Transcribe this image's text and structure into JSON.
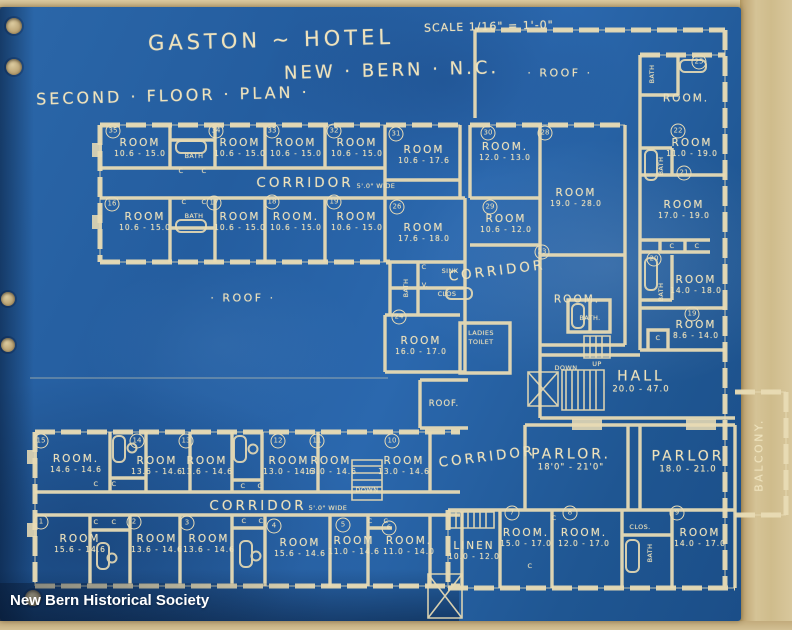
{
  "title": {
    "hotel": "GASTON ~ HOTEL",
    "city": "NEW · BERN · N.C.",
    "plan": "SECOND · FLOOR · PLAN ·",
    "scale": "SCALE 1/16\" = 1'-0\""
  },
  "watermark": "New Bern Historical Society",
  "colors": {
    "blueprint_blue": "#24609f",
    "line_cream": "#e9dcb6",
    "paper_tan": "#cfbb8f"
  },
  "plan": {
    "rooms": [
      {
        "n": "35",
        "t": "ROOM",
        "d": "10.6 - 15.0",
        "x": 140,
        "y": 148,
        "nx": 113,
        "ny": 131
      },
      {
        "n": "34",
        "t": "ROOM",
        "d": "10.6 - 15.0",
        "x": 240,
        "y": 148,
        "nx": 216,
        "ny": 131
      },
      {
        "n": "33",
        "t": "ROOM",
        "d": "10.6 - 15.0",
        "x": 296,
        "y": 148,
        "nx": 272,
        "ny": 131
      },
      {
        "n": "32",
        "t": "ROOM",
        "d": "10.6 - 15.0",
        "x": 357,
        "y": 148,
        "nx": 334,
        "ny": 131
      },
      {
        "n": "31",
        "t": "ROOM",
        "d": "10.6 - 17.6",
        "x": 424,
        "y": 155,
        "nx": 396,
        "ny": 134
      },
      {
        "n": "16",
        "t": "ROOM",
        "d": "10.6 - 15.0",
        "x": 145,
        "y": 222,
        "nx": 112,
        "ny": 204
      },
      {
        "n": "17",
        "t": "ROOM",
        "d": "10.6 - 15.0",
        "x": 240,
        "y": 222,
        "nx": 214,
        "ny": 203
      },
      {
        "n": "18",
        "t": "ROOM.",
        "d": "10.6 - 15.0",
        "x": 296,
        "y": 222,
        "nx": 272,
        "ny": 202
      },
      {
        "n": "19",
        "t": "ROOM",
        "d": "10.6 - 15.0",
        "x": 357,
        "y": 222,
        "nx": 334,
        "ny": 202
      },
      {
        "n": "26",
        "t": "ROOM",
        "d": "17.6 - 18.0",
        "x": 424,
        "y": 233,
        "nx": 397,
        "ny": 207
      },
      {
        "n": "30",
        "t": "ROOM.",
        "d": "12.0 - 13.0",
        "x": 505,
        "y": 152,
        "nx": 488,
        "ny": 133
      },
      {
        "n": "28",
        "t": "ROOM",
        "d": "19.0 - 28.0",
        "x": 576,
        "y": 198,
        "nx": 545,
        "ny": 133
      },
      {
        "n": "29",
        "t": "ROOM",
        "d": "10.6 - 12.0",
        "x": 506,
        "y": 224,
        "nx": 490,
        "ny": 207
      },
      {
        "n": "24",
        "t": "ROOM",
        "d": "16.0 - 17.0",
        "x": 421,
        "y": 346,
        "nx": 399,
        "ny": 317
      },
      {
        "n": "23",
        "t": "ROOM.",
        "d": null,
        "x": 577,
        "y": 300,
        "nx": 542,
        "ny": 252
      },
      {
        "n": "25",
        "t": "ROOM.",
        "d": null,
        "x": 686,
        "y": 99,
        "nx": 699,
        "ny": 62
      },
      {
        "n": "22",
        "t": "ROOM",
        "d": "11.0 - 19.0",
        "x": 692,
        "y": 148,
        "nx": 678,
        "ny": 131
      },
      {
        "n": "21",
        "t": "ROOM",
        "d": "17.0 - 19.0",
        "x": 684,
        "y": 210,
        "nx": 684,
        "ny": 173
      },
      {
        "n": "20",
        "t": "ROOM",
        "d": "14.0 - 18.0",
        "x": 696,
        "y": 285,
        "nx": 654,
        "ny": 259
      },
      {
        "n": "19",
        "t": "ROOM",
        "d": "8.6 - 14.0",
        "x": 696,
        "y": 330,
        "nx": 692,
        "ny": 314
      },
      {
        "n": "15",
        "t": "ROOM.",
        "d": "14.6 - 14.6",
        "x": 76,
        "y": 464,
        "nx": 41,
        "ny": 441
      },
      {
        "n": "14",
        "t": "ROOM",
        "d": "13.6 - 14.6",
        "x": 157,
        "y": 466,
        "nx": 137,
        "ny": 441
      },
      {
        "n": "13",
        "t": "ROOM",
        "d": "13.6 - 14.6",
        "x": 207,
        "y": 466,
        "nx": 186,
        "ny": 441
      },
      {
        "n": "12",
        "t": "ROOM",
        "d": "13.0 - 14.6",
        "x": 289,
        "y": 466,
        "nx": 278,
        "ny": 441
      },
      {
        "n": "11",
        "t": "ROOM",
        "d": "13.0 - 14.6",
        "x": 331,
        "y": 466,
        "nx": 317,
        "ny": 441
      },
      {
        "n": "10",
        "t": "ROOM",
        "d": "13.0 - 14.6",
        "x": 404,
        "y": 466,
        "nx": 392,
        "ny": 441
      },
      {
        "n": "1",
        "t": "ROOM",
        "d": "15.6 - 14.6",
        "x": 80,
        "y": 544,
        "nx": 41,
        "ny": 522
      },
      {
        "n": "2",
        "t": "ROOM",
        "d": "13.6 - 14.6",
        "x": 157,
        "y": 544,
        "nx": 134,
        "ny": 522
      },
      {
        "n": "3",
        "t": "ROOM",
        "d": "13.6 - 14.6",
        "x": 209,
        "y": 544,
        "nx": 187,
        "ny": 523
      },
      {
        "n": "4",
        "t": "ROOM",
        "d": "15.6 - 14.6",
        "x": 300,
        "y": 548,
        "nx": 274,
        "ny": 526
      },
      {
        "n": "5",
        "t": "ROOM",
        "d": "11.0 - 14.6",
        "x": 354,
        "y": 546,
        "nx": 343,
        "ny": 525
      },
      {
        "n": "6",
        "t": "ROOM.",
        "d": "11.0 - 14.0",
        "x": 409,
        "y": 546,
        "nx": 389,
        "ny": 528
      },
      {
        "n": "7",
        "t": "ROOM.",
        "d": "15.0 - 17.0",
        "x": 526,
        "y": 538,
        "nx": 512,
        "ny": 513
      },
      {
        "n": "8",
        "t": "ROOM.",
        "d": "12.0 - 17.0",
        "x": 584,
        "y": 538,
        "nx": 570,
        "ny": 513
      },
      {
        "n": "9",
        "t": "ROOM",
        "d": "14.0 - 17.0",
        "x": 700,
        "y": 538,
        "nx": 677,
        "ny": 513
      },
      {
        "t": "LINEN",
        "d": "10.0 - 12.0",
        "x": 474,
        "y": 551
      },
      {
        "t": "HALL",
        "d": "20.0 - 47.0",
        "x": 641,
        "y": 382,
        "c": "big"
      },
      {
        "t": "PARLOR.",
        "d": "18'0\" - 21'0\"",
        "x": 571,
        "y": 460,
        "c": "big"
      },
      {
        "t": "PARLOR",
        "d": "18.0 - 21.0",
        "x": 688,
        "y": 462,
        "c": "big"
      }
    ],
    "texts": [
      {
        "t": "· ROOF ·",
        "x": 560,
        "y": 73,
        "c": "med"
      },
      {
        "t": "· ROOF ·",
        "x": 243,
        "y": 298,
        "c": "med"
      },
      {
        "t": "ROOF.",
        "x": 444,
        "y": 404,
        "c": "small"
      },
      {
        "t": "CORRIDOR",
        "x": 305,
        "y": 183,
        "c": "big"
      },
      {
        "t": "5'.0\" WIDE",
        "x": 376,
        "y": 186,
        "c": "tiny"
      },
      {
        "t": "CORRIDOR",
        "x": 497,
        "y": 271,
        "c": "big",
        "r": -7
      },
      {
        "t": "CORRIDOR",
        "x": 487,
        "y": 457,
        "c": "big",
        "r": -7
      },
      {
        "t": "CORRIDOR",
        "x": 258,
        "y": 506,
        "c": "big"
      },
      {
        "t": "5'.0\" WIDE",
        "x": 328,
        "y": 508,
        "c": "tiny"
      },
      {
        "t": "BALCONY.",
        "x": 759,
        "y": 455,
        "c": "med",
        "r": -90
      },
      {
        "t": "DOWN",
        "x": 566,
        "y": 368,
        "c": "tiny"
      },
      {
        "t": "UP",
        "x": 597,
        "y": 364,
        "c": "tiny"
      },
      {
        "t": "DOWN",
        "x": 367,
        "y": 490,
        "c": "tiny"
      },
      {
        "t": "LADIES",
        "x": 481,
        "y": 333,
        "c": "tiny"
      },
      {
        "t": "TOILET",
        "x": 481,
        "y": 342,
        "c": "tiny"
      },
      {
        "t": "SINK",
        "x": 450,
        "y": 271,
        "c": "tiny"
      },
      {
        "t": "V.",
        "x": 425,
        "y": 285,
        "c": "tiny"
      },
      {
        "t": "CLOS",
        "x": 447,
        "y": 294,
        "c": "tiny"
      },
      {
        "t": "C",
        "x": 424,
        "y": 267,
        "c": "tiny"
      },
      {
        "t": "BATH",
        "x": 194,
        "y": 156,
        "c": "tiny"
      },
      {
        "t": "C",
        "x": 181,
        "y": 171,
        "c": "tiny"
      },
      {
        "t": "C",
        "x": 204,
        "y": 171,
        "c": "tiny"
      },
      {
        "t": "C",
        "x": 184,
        "y": 202,
        "c": "tiny"
      },
      {
        "t": "C",
        "x": 204,
        "y": 202,
        "c": "tiny"
      },
      {
        "t": "BATH",
        "x": 194,
        "y": 216,
        "c": "tiny"
      },
      {
        "t": "BATH",
        "x": 406,
        "y": 288,
        "c": "tiny",
        "r": -90
      },
      {
        "t": "BATH",
        "x": 652,
        "y": 74,
        "c": "tiny",
        "r": -90
      },
      {
        "t": "BATH",
        "x": 661,
        "y": 166,
        "c": "tiny",
        "r": -90
      },
      {
        "t": "BATH",
        "x": 661,
        "y": 292,
        "c": "tiny",
        "r": -90
      },
      {
        "t": "BATH.",
        "x": 590,
        "y": 318,
        "c": "tiny"
      },
      {
        "t": "CLOS.",
        "x": 640,
        "y": 527,
        "c": "tiny"
      },
      {
        "t": "BATH",
        "x": 650,
        "y": 553,
        "c": "tiny",
        "r": -90
      },
      {
        "t": "C",
        "x": 672,
        "y": 246,
        "c": "tiny"
      },
      {
        "t": "C",
        "x": 697,
        "y": 246,
        "c": "tiny"
      },
      {
        "t": "C",
        "x": 658,
        "y": 338,
        "c": "tiny"
      },
      {
        "t": "C",
        "x": 96,
        "y": 484,
        "c": "tiny"
      },
      {
        "t": "C",
        "x": 114,
        "y": 484,
        "c": "tiny"
      },
      {
        "t": "C",
        "x": 243,
        "y": 486,
        "c": "tiny"
      },
      {
        "t": "C",
        "x": 260,
        "y": 486,
        "c": "tiny"
      },
      {
        "t": "C",
        "x": 96,
        "y": 522,
        "c": "tiny"
      },
      {
        "t": "C",
        "x": 114,
        "y": 522,
        "c": "tiny"
      },
      {
        "t": "C",
        "x": 244,
        "y": 521,
        "c": "tiny"
      },
      {
        "t": "C",
        "x": 261,
        "y": 521,
        "c": "tiny"
      },
      {
        "t": "C",
        "x": 370,
        "y": 521,
        "c": "tiny"
      },
      {
        "t": "C",
        "x": 386,
        "y": 521,
        "c": "tiny"
      },
      {
        "t": "C",
        "x": 554,
        "y": 518,
        "c": "tiny"
      },
      {
        "t": "C",
        "x": 530,
        "y": 566,
        "c": "tiny"
      }
    ]
  }
}
